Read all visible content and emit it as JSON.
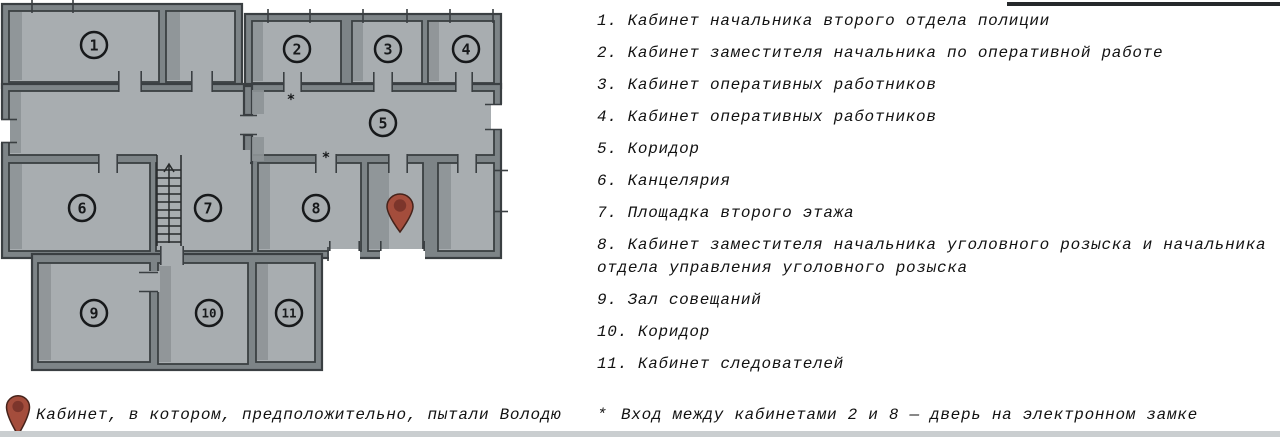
{
  "plan": {
    "room_numbers": [
      "1",
      "2",
      "3",
      "4",
      "5",
      "6",
      "7",
      "8",
      "9",
      "10",
      "11"
    ],
    "door_asterisk": "*",
    "colors": {
      "room_fill": "#a8adb0",
      "wall_core": "#7d8487",
      "wall_line": "#3a3f42",
      "shade_strip": "#8e9497",
      "pin_red": "#a44d3c",
      "pin_inner": "#7c352b"
    }
  },
  "legend": {
    "items": [
      {
        "num": "1.",
        "text": "Кабинет начальника второго отдела полиции"
      },
      {
        "num": "2.",
        "text": "Кабинет заместителя начальника по оперативной работе"
      },
      {
        "num": "3.",
        "text": "Кабинет оперативных работников"
      },
      {
        "num": "4.",
        "text": "Кабинет оперативных работников"
      },
      {
        "num": "5.",
        "text": "Коридор"
      },
      {
        "num": "6.",
        "text": "Канцелярия"
      },
      {
        "num": "7.",
        "text": "Площадка второго этажа"
      },
      {
        "num": "8.",
        "text": "Кабинет заместителя начальника уголовного розыска и начальника отдела управления уголовного розыска"
      },
      {
        "num": "9.",
        "text": "Зал совещаний"
      },
      {
        "num": "10.",
        "text": "Коридор"
      },
      {
        "num": "11.",
        "text": "Кабинет следователей"
      }
    ]
  },
  "footnotes": {
    "pin_caption": "Кабинет, в котором, предположительно, пытали Володю",
    "door_note_mark": "*",
    "door_note": "Вход между кабинетами 2 и 8 — дверь на электронном замке"
  }
}
